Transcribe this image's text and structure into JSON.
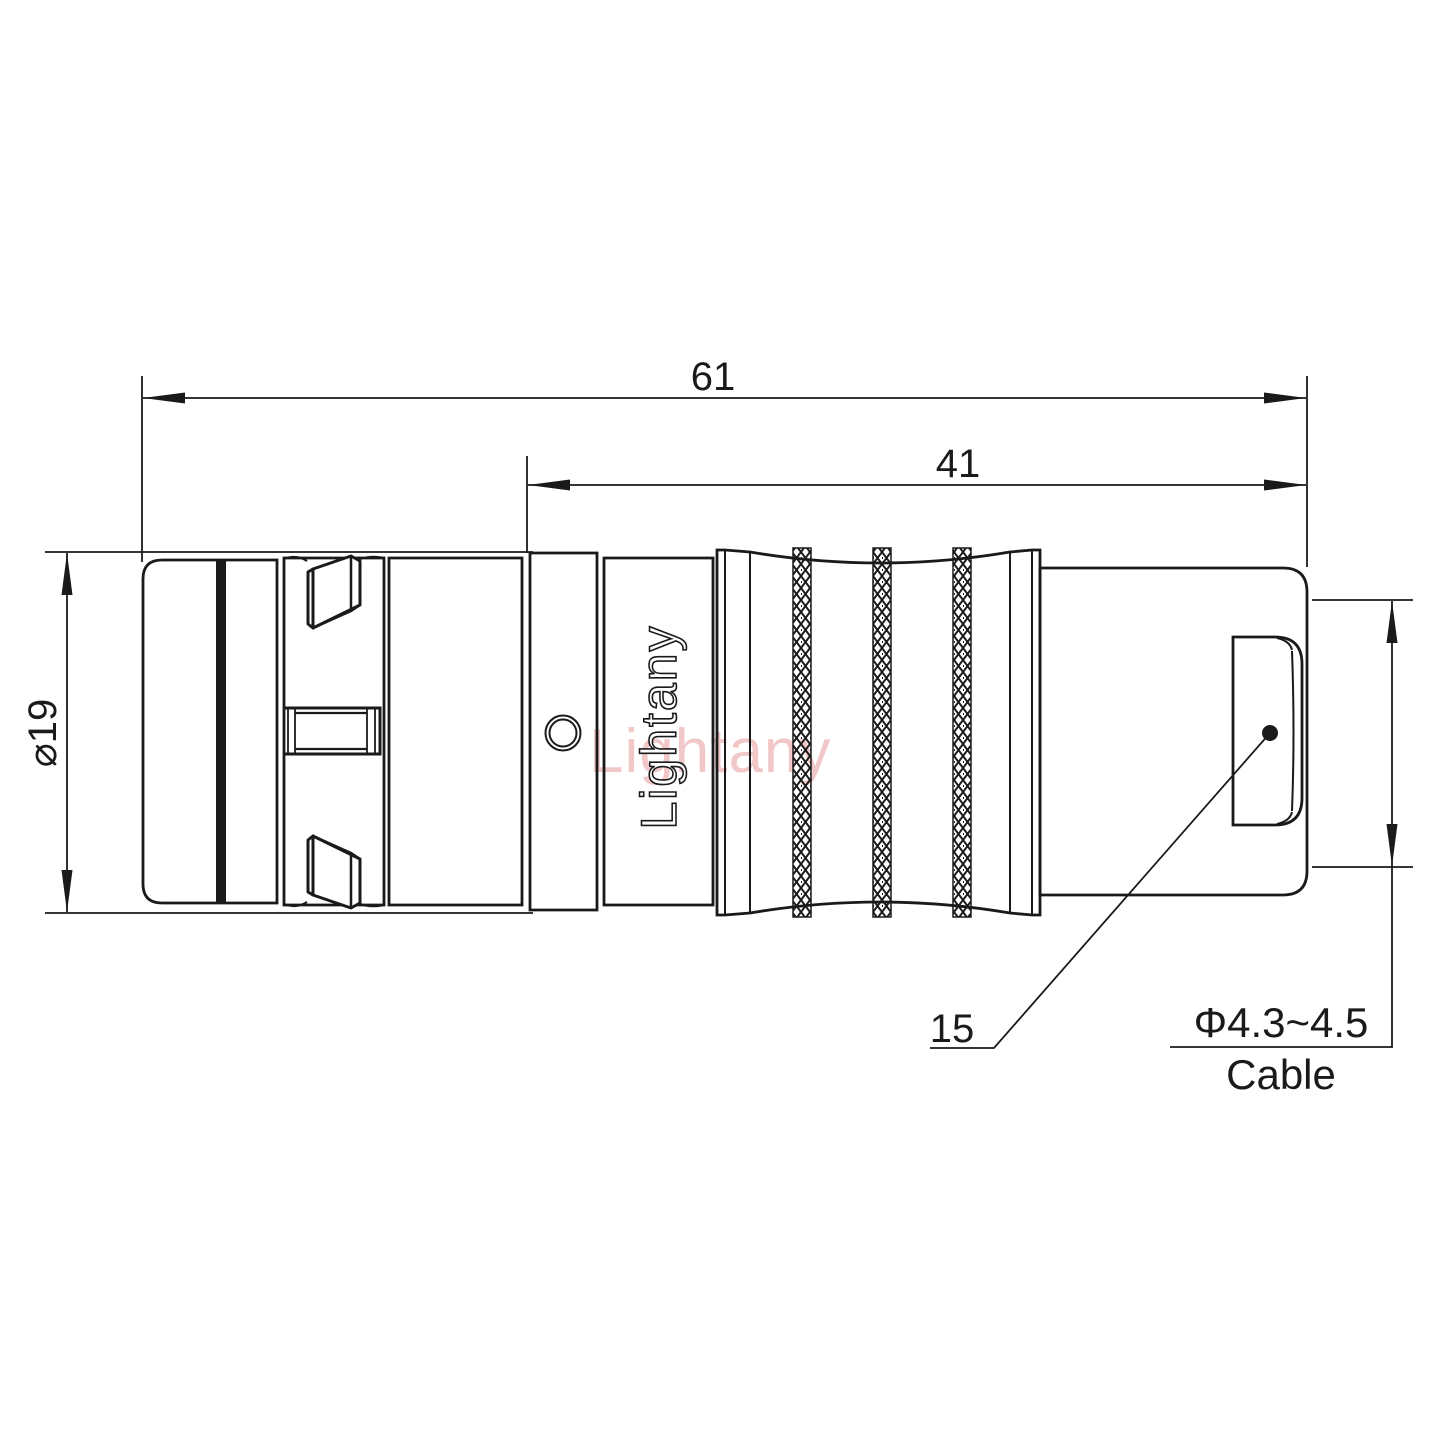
{
  "drawing": {
    "title": "connector-technical-drawing",
    "dimensions": {
      "overall_length": "61",
      "rear_length": "41",
      "body_diameter": "⌀19",
      "boot_length": "15",
      "cable_diameter": "Φ4.3~4.5",
      "cable_word": "Cable"
    },
    "branding": {
      "body_logo": "Lightany",
      "watermark": "Lightany"
    },
    "colors": {
      "line": "#1a1a1a",
      "watermark_pink": "#e89a9a",
      "background": "#ffffff"
    }
  }
}
